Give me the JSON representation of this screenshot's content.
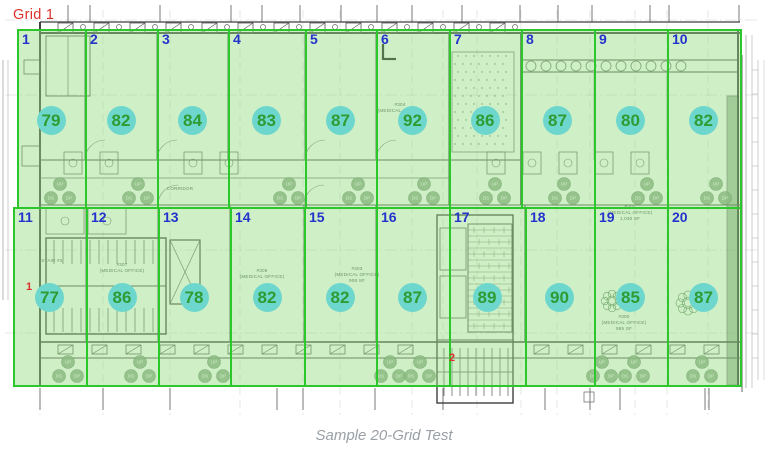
{
  "page": {
    "caption": "Sample 20-Grid Test",
    "background": "#ffffff"
  },
  "grid": {
    "label": "Grid 1",
    "rows": 2,
    "cols": 10,
    "cells": [
      {
        "number": "1",
        "value": "79"
      },
      {
        "number": "2",
        "value": "82"
      },
      {
        "number": "3",
        "value": "84"
      },
      {
        "number": "4",
        "value": "83"
      },
      {
        "number": "5",
        "value": "87"
      },
      {
        "number": "6",
        "value": "92"
      },
      {
        "number": "7",
        "value": "86"
      },
      {
        "number": "8",
        "value": "87"
      },
      {
        "number": "9",
        "value": "80"
      },
      {
        "number": "10",
        "value": "82"
      },
      {
        "number": "11",
        "value": "77"
      },
      {
        "number": "12",
        "value": "86"
      },
      {
        "number": "13",
        "value": "78"
      },
      {
        "number": "14",
        "value": "82"
      },
      {
        "number": "15",
        "value": "82"
      },
      {
        "number": "16",
        "value": "87"
      },
      {
        "number": "17",
        "value": "89"
      },
      {
        "number": "18",
        "value": "90"
      },
      {
        "number": "19",
        "value": "85"
      },
      {
        "number": "20",
        "value": "87"
      }
    ]
  },
  "stair_markers": [
    {
      "label": "1",
      "x": 29,
      "y": 287
    },
    {
      "label": "2",
      "x": 452,
      "y": 358
    }
  ],
  "room_labels": [
    {
      "text": "#307\n(MEDICAL OFFICE)",
      "x": 122,
      "y": 262
    },
    {
      "text": "#305\n(MEDICAL OFFICE)",
      "x": 262,
      "y": 268
    },
    {
      "text": "#303\n(MEDICAL OFFICE)\n908 SF",
      "x": 357,
      "y": 266
    },
    {
      "text": "#304\n(MEDICAL OFFICE)",
      "x": 400,
      "y": 102
    },
    {
      "text": "#301\n(MEDICAL OFFICE)\n1,030 SF",
      "x": 630,
      "y": 204
    },
    {
      "text": "#300\n(MEDICAL OFFICE)\n985 SF",
      "x": 624,
      "y": 314
    },
    {
      "text": "CORRIDOR",
      "x": 180,
      "y": 186
    },
    {
      "text": "STAIR #2",
      "x": 52,
      "y": 258
    }
  ],
  "plan": {
    "symbols": {
      "up": "UP",
      "ds": "DS",
      "dp": "DP"
    }
  },
  "colors": {
    "grid_line": "#2bc72b",
    "grid_fill": "#96dc84",
    "cell_number": "#2433cb",
    "value_circle": "#6ed7cd",
    "value_text": "#2f9c33",
    "annotation_red": "#da322a",
    "caption_gray": "#9aa0a6",
    "plan_line": "#4a4a4a"
  }
}
